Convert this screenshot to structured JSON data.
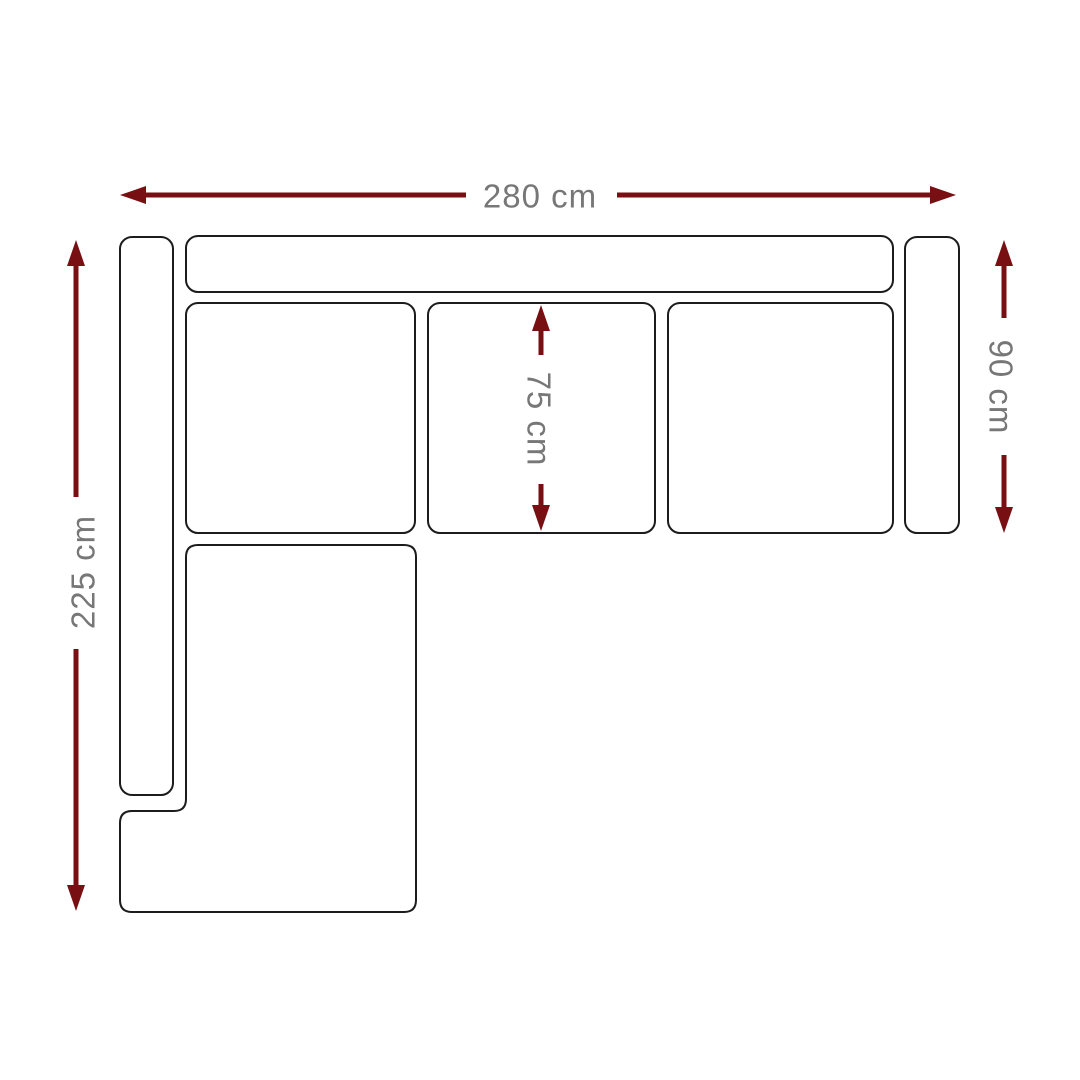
{
  "diagram": {
    "subject": "corner sofa top view with dimensions",
    "background": "#ffffff"
  },
  "colors": {
    "arrow": "#780f13",
    "label": "#777777",
    "outline": "#1c1c1c"
  },
  "dimensions": {
    "width": {
      "label": "280 cm"
    },
    "depth_left": {
      "label": "225 cm"
    },
    "depth_right": {
      "label": "90 cm"
    },
    "seat": {
      "label": "75 cm"
    }
  }
}
